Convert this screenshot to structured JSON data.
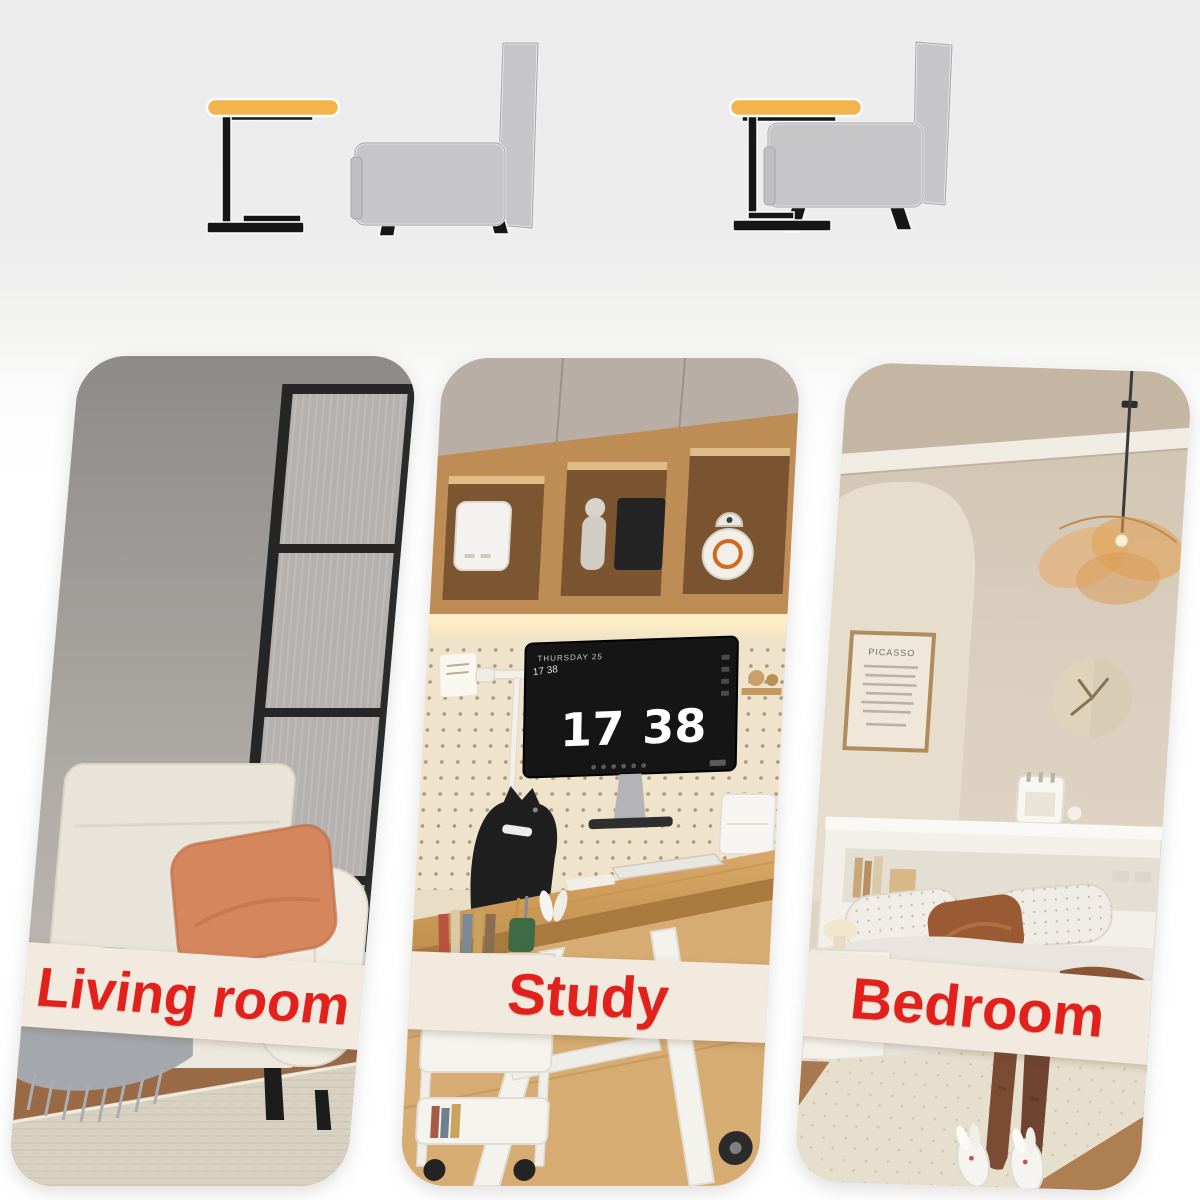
{
  "hero": {
    "diagrams": [
      {
        "id": "table-beside-chair",
        "table_icon": "c-side-table-icon",
        "chair_icon": "armchair-icon"
      },
      {
        "id": "table-over-chair",
        "table_icon": "c-side-table-icon",
        "chair_icon": "armchair-icon"
      }
    ]
  },
  "gallery": {
    "cards": [
      {
        "id": "living-room",
        "label": "Living room"
      },
      {
        "id": "study",
        "label": "Study"
      },
      {
        "id": "bedroom",
        "label": "Bedroom"
      }
    ]
  },
  "study_monitor": {
    "date_line": "THURSDAY 25",
    "corner_time": "17 38",
    "hours": "17",
    "minutes": "38"
  },
  "bedroom": {
    "poster_title": "PICASSO"
  },
  "palette": {
    "accent_yellow": "#F2B44B",
    "icon_gray": "#C5C5C7",
    "icon_black": "#161616",
    "label_red": "#E2211C",
    "band_cream": "#F2EADE",
    "hero_bg": "#EDEDED"
  }
}
